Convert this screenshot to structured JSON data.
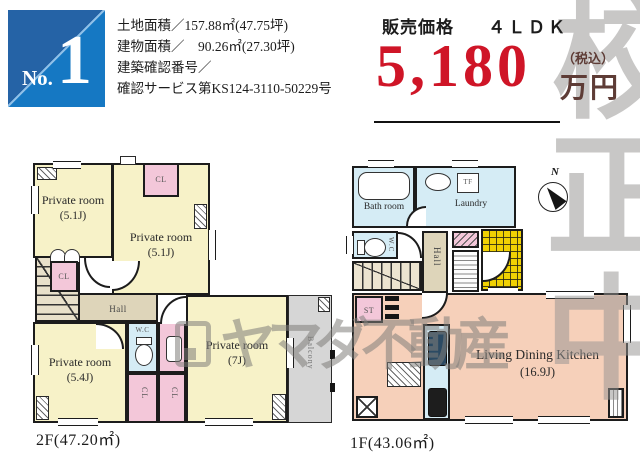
{
  "colors": {
    "accent_red": "#cf1527",
    "price_unit_maroon": "#5e3c36",
    "badge_blue_dark": "#2563a6",
    "badge_blue_light": "#1578c3",
    "room_yellow": "#f7f2c8",
    "closet_pink": "#f3c7d9",
    "water_blue": "#d5ecf5",
    "ldk_salmon": "#f6d0ba",
    "hall_tan": "#ded5ba",
    "entrance_tile_yellow": "#f0d103",
    "balcony_gray": "#d6d6d6",
    "watermark_gray": "#8a8a8a"
  },
  "header": {
    "badge": {
      "prefix": "No.",
      "number": "1"
    },
    "info_lines": [
      "土地面積／157.88㎡(47.75坪)",
      "建物面積／　90.26㎡(27.30坪)",
      "建築確認番号／",
      "確認サービス第KS124-3110-50229号"
    ],
    "price": {
      "label": "販売価格",
      "plan_type": "４ＬＤＫ",
      "amount": "5,180",
      "tax_note": "（税込）",
      "unit": "万円"
    }
  },
  "watermarks": {
    "proof_stamp": [
      "校",
      "正",
      "中"
    ],
    "brand": "ヤマダ不動産"
  },
  "floor_2f": {
    "floor_label": "2F(47.20㎡)",
    "room_a_name": "Private room",
    "room_a_size": "(5.1J)",
    "room_b_name": "Private room",
    "room_b_size": "(5.1J)",
    "room_c_name": "Private room",
    "room_c_size": "(5.4J)",
    "room_d_name": "Private room",
    "room_d_size": "(7J)",
    "closet": "CL",
    "wc": "W.C",
    "hall": "Hall",
    "balcony": "Balcony"
  },
  "floor_1f": {
    "floor_label": "1F(43.06㎡)",
    "bath": "Bath room",
    "laundry": "Laundry",
    "tf": "TF",
    "wc": "W.C",
    "hall": "Hall",
    "storage": "ST",
    "ldk_name": "Living Dining Kitchen",
    "ldk_size": "(16.9J)",
    "compass": "N"
  }
}
